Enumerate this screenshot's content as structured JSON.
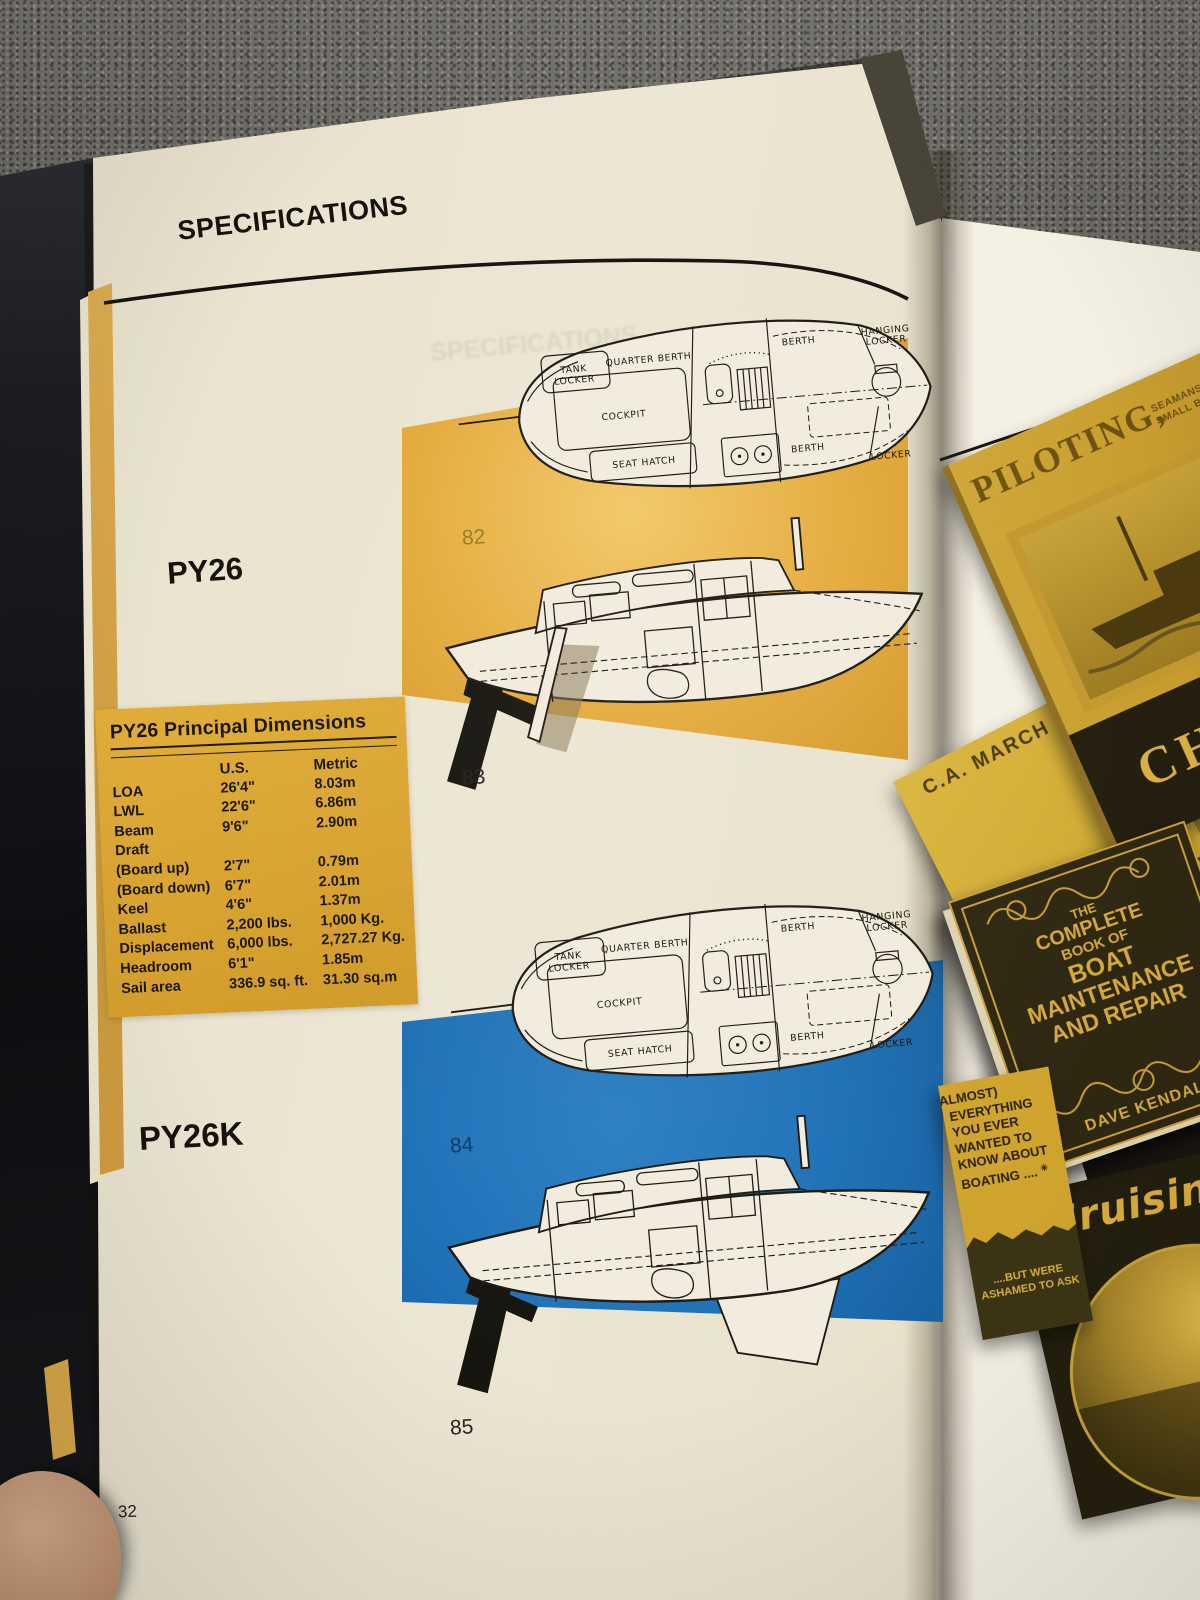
{
  "page": {
    "header": "SPECIFICATIONS",
    "page_number": "32",
    "models": {
      "py26": {
        "label": "PY26",
        "fig_plan": "82",
        "fig_side": "83"
      },
      "py26k": {
        "label": "PY26K",
        "fig_plan": "84",
        "fig_side": "85"
      }
    },
    "diagram_labels": {
      "tank": "TANK",
      "locker": "LOCKER",
      "quarter_berth": "QUARTER BERTH",
      "cockpit": "COCKPIT",
      "seat_hatch": "SEAT HATCH",
      "berth": "BERTH",
      "hanging": "HANGING"
    },
    "table": {
      "title": "PY26 Principal Dimensions",
      "columns": [
        "U.S.",
        "Metric"
      ],
      "rows": [
        {
          "label": "LOA",
          "us": "26'4\"",
          "metric": "8.03m"
        },
        {
          "label": "LWL",
          "us": "22'6\"",
          "metric": "6.86m"
        },
        {
          "label": "Beam",
          "us": "9'6\"",
          "metric": "2.90m"
        },
        {
          "label": "Draft",
          "us": "",
          "metric": ""
        },
        {
          "label": "(Board up)",
          "us": "2'7\"",
          "metric": "0.79m"
        },
        {
          "label": "(Board down)",
          "us": "6'7\"",
          "metric": "2.01m"
        },
        {
          "label": "Keel",
          "us": "4'6\"",
          "metric": "1.37m"
        },
        {
          "label": "Ballast",
          "us": "2,200 lbs.",
          "metric": "1,000 Kg."
        },
        {
          "label": "Displacement",
          "us": "6,000 lbs.",
          "metric": "2,727.27 Kg."
        },
        {
          "label": "Headroom",
          "us": "6'1\"",
          "metric": "1.85m"
        },
        {
          "label": "Sail area",
          "us": "336.9 sq. ft.",
          "metric": "31.30 sq.m"
        }
      ]
    }
  },
  "books": {
    "chapman": {
      "title": "PILOTING,",
      "subtitle_1": "SEAMANSHIP AND",
      "subtitle_2": "SMALL BOAT HANDLING",
      "bottom_title": "CHAPM"
    },
    "marchaj": {
      "author": "C.A. MARCH",
      "title": "SAILING THEORY AND PRACTICE"
    },
    "sea": {
      "title": "SEA"
    },
    "maintenance": {
      "lines": [
        "THE",
        "COMPLETE",
        "BOOK OF",
        "BOAT",
        "MAINTENANCE",
        "AND REPAIR"
      ],
      "author": "DAVE KENDALL"
    },
    "pamphlet": {
      "top_lines": [
        "(ALMOST)",
        "EVERYTHING",
        "YOU EVER",
        "WANTED TO",
        "KNOW ABOUT",
        "BOATING ...."
      ],
      "star": "✳",
      "bottom_lines": [
        "....BUT WERE",
        "ASHAMED TO ASK"
      ]
    },
    "cruising": {
      "title": "Cruising"
    }
  },
  "colors": {
    "gold_patch": "#E2A93C",
    "blue_patch": "#1E6FB5",
    "table_background": "#D8A22E",
    "page_cream": "#EAE3CF",
    "right_page": "#F5F1E6",
    "carpet_gray": "#6E6C66",
    "cover_gold": "#C79E2F",
    "cover_dark": "#2E2712"
  }
}
